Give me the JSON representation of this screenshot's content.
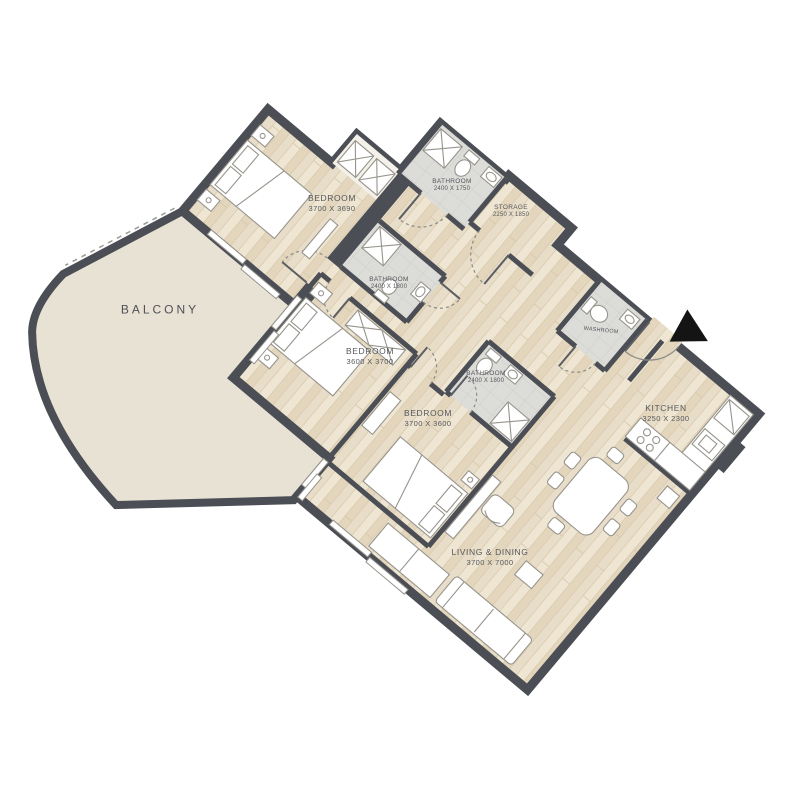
{
  "plan": {
    "type": "apartment_floor_plan",
    "rotation_deg": 40,
    "colors": {
      "background": "#ffffff",
      "wall": "#4b4e54",
      "floor_wood": "#e8ddc8",
      "floor_plank_dark": "#e3d6bd",
      "floor_plank_light": "#eee5d2",
      "bathroom_tile": "#dcdcd9",
      "balcony_floor": "#e8e2d5",
      "label_text": "#56585c",
      "entrance_marker": "#141414"
    },
    "rooms": {
      "bedroom1": {
        "label": "BEDROOM",
        "dims": "3700 X 3690"
      },
      "bathroom1": {
        "label": "BATHROOM",
        "dims": "2400 X 1750"
      },
      "storage": {
        "label": "STORAGE",
        "dims": "2250 X 1850"
      },
      "bathroom2": {
        "label": "BATHROOM",
        "dims": "2400 X 1800"
      },
      "bedroom2": {
        "label": "BEDROOM",
        "dims": "3600 X 3700"
      },
      "bathroom3": {
        "label": "BATHROOM",
        "dims": "2400 X 1800"
      },
      "bedroom3": {
        "label": "BEDROOM",
        "dims": "3700 X 3600"
      },
      "washroom": {
        "label": "WASHROOM"
      },
      "kitchen": {
        "label": "KITCHEN",
        "dims": "3250 X 2300"
      },
      "living_dining": {
        "label": "LIVING & DINING",
        "dims": "3700 X 7000"
      },
      "balcony": {
        "label": "BALCONY"
      }
    }
  }
}
